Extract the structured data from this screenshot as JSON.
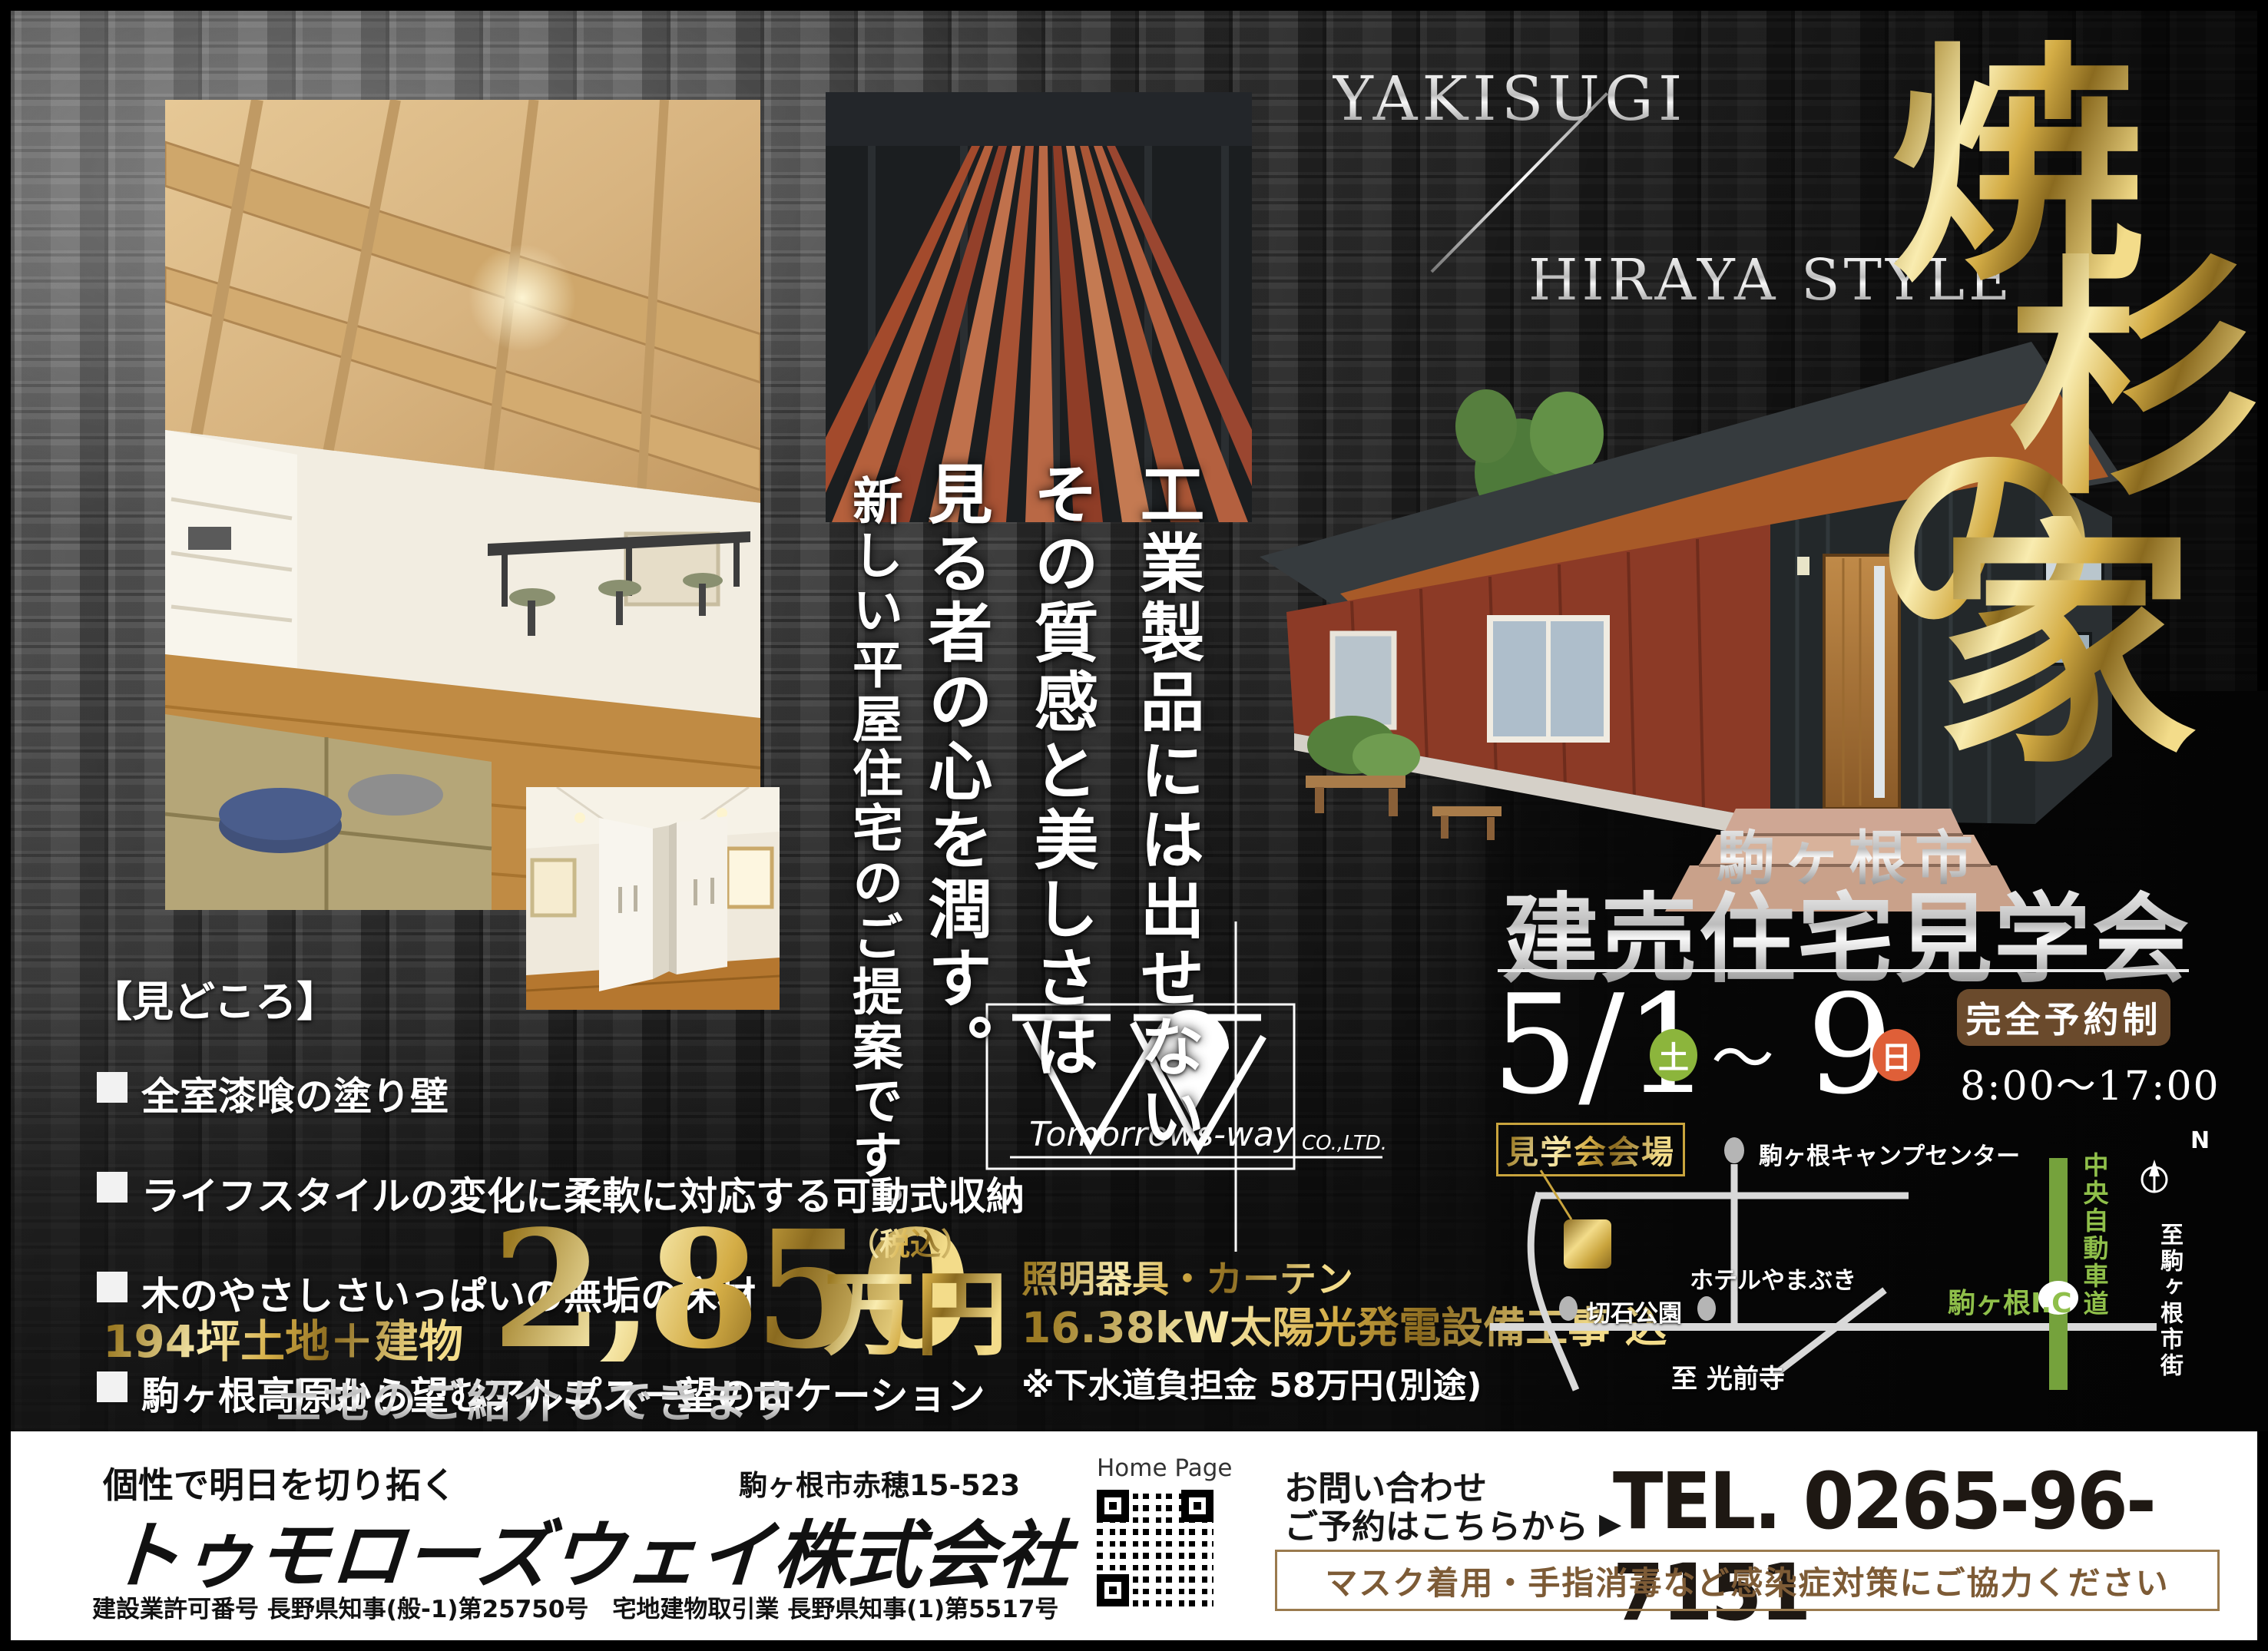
{
  "header": {
    "yakisugi": "YAKISUGI",
    "hiraya": "HIRAYA STYLE",
    "title_chars": [
      "焼",
      "杉",
      "の",
      "家"
    ]
  },
  "tagline": {
    "line1": "工業製品には出せない",
    "line2": "その質感と美しさは",
    "line3": "見る者の心を潤す。",
    "line4": "新しい平屋住宅のご提案です。"
  },
  "highlights": {
    "heading": "【見どころ】",
    "items": [
      {
        "label": "全室漆喰の塗り壁"
      },
      {
        "label": "ライフスタイルの変化に柔軟に対応する可動式収納"
      },
      {
        "label": "木のやさしさいっぱいの無垢の床材"
      },
      {
        "label": "駒ヶ根高原から望むアルプス一望のロケーション"
      }
    ]
  },
  "price": {
    "land_label": "194坪土地＋建物",
    "amount": "2,850",
    "unit": "万円",
    "tax_note": "（税込）",
    "included_1": "照明器具・カーテン",
    "included_2": "16.38kW太陽光発電設備工事 込",
    "note": "※下水道負担金 58万円(別途)",
    "land_intro": "土地のご紹介もできます"
  },
  "event": {
    "city": "駒ヶ根市",
    "title": "建売住宅見学会",
    "date_start": "5/1",
    "date_start_day": "土",
    "tilde": "～",
    "date_end": "9",
    "date_end_day": "日",
    "reservation": "完全予約制",
    "hours": "8:00～17:00"
  },
  "map": {
    "venue_label": "見学会会場",
    "camp": "駒ヶ根キャンプセンター",
    "hotel": "ホテルやまぶき",
    "park": "切石公園",
    "temple": "至 光前寺",
    "ic": "駒ヶ根I.C",
    "highway": "中央自動車道",
    "city_dir": "至駒ヶ根市街",
    "north": "N"
  },
  "logo": {
    "name": "Tomorrows-way",
    "suffix": "CO.,LTD."
  },
  "footer": {
    "catchphrase": "個性で明日を切り拓く",
    "company": "トゥモローズウェイ株式会社",
    "address": "駒ヶ根市赤穂15-523",
    "homepage": "Home Page",
    "contact_1": "お問い合わせ",
    "contact_2": "ご予約はこちらから",
    "arrow": "▶",
    "tel": "TEL. 0265-96-7151",
    "covid_note": "マスク着用・手指消毒など感染症対策にご協力ください",
    "license": "建設業許可番号 長野県知事(般-1)第25750号　宅地建物取引業 長野県知事(1)第5517号"
  },
  "colors": {
    "gold": "#c9a43d",
    "silver": "#cfcfcf",
    "green_badge": "#8cb53c",
    "orange_badge": "#df5f38",
    "brown_box": "#6a4a2c",
    "map_road_green": "#75a23c",
    "covid_brown": "#7d5b36"
  }
}
